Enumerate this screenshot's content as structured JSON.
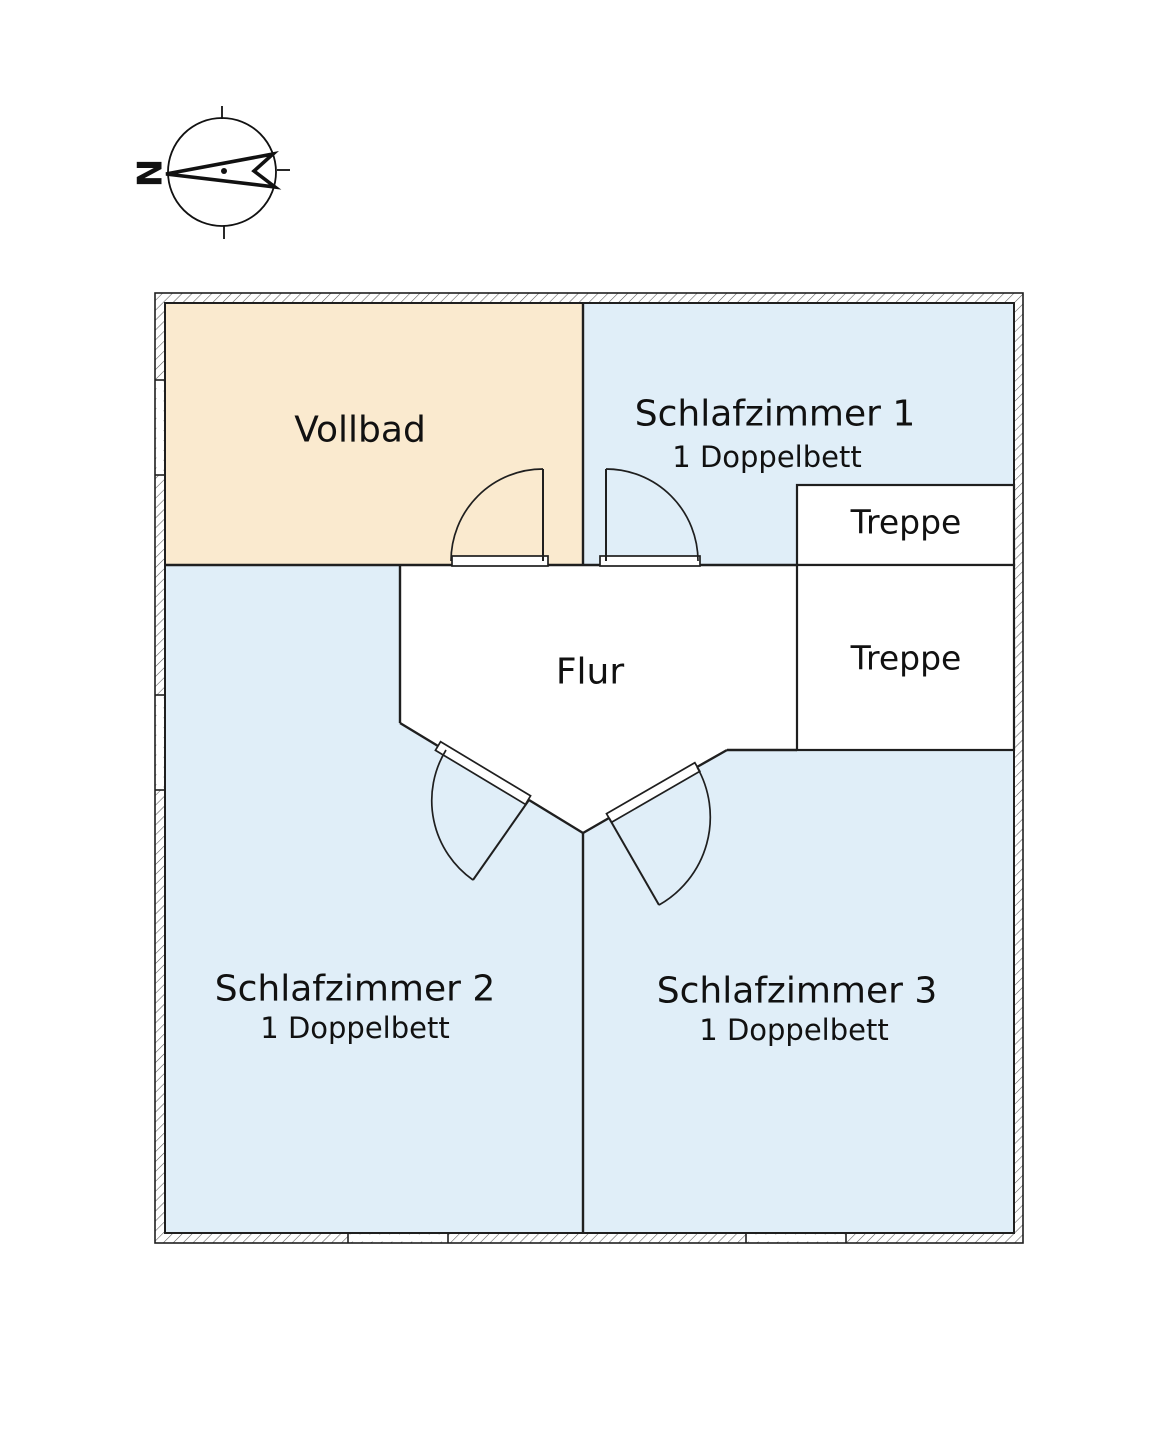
{
  "compass": {
    "north_label": "N"
  },
  "rooms": {
    "vollbad": {
      "label": "Vollbad"
    },
    "schlafzimmer1": {
      "label": "Schlafzimmer 1",
      "sublabel": "1 Doppelbett"
    },
    "treppe_upper": {
      "label": "Treppe"
    },
    "treppe_lower": {
      "label": "Treppe"
    },
    "flur": {
      "label": "Flur"
    },
    "schlafzimmer2": {
      "label": "Schlafzimmer 2",
      "sublabel": "1 Doppelbett"
    },
    "schlafzimmer3": {
      "label": "Schlafzimmer 3",
      "sublabel": "1 Doppelbett"
    }
  },
  "colors": {
    "bathroom_fill": "#faeacf",
    "bedroom_fill": "#e0eef8",
    "hall_fill": "#ffffff",
    "stairs_fill": "#ffffff",
    "line": "#1f1f1f"
  }
}
